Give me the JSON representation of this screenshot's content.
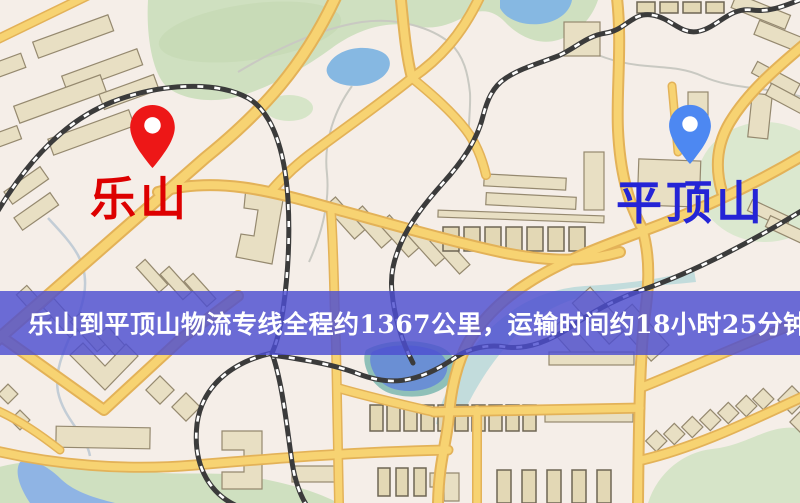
{
  "map": {
    "origin": {
      "name": "乐山",
      "pin_color": "#ed1717",
      "label_color": "#dd0000"
    },
    "destination": {
      "name": "平顶山",
      "pin_color": "#4d88f2",
      "label_color": "#2424d6"
    },
    "banner": {
      "text": "乐山到平顶山物流专线全程约1367公里，运输时间约18小时25分钟.",
      "background": "#4d4ed1",
      "text_color": "#ffffff",
      "distance_km": "1367",
      "duration_hours": "18",
      "duration_minutes": "25"
    },
    "palette": {
      "background": "#f5eee8",
      "road": "#f7d372",
      "road_casing": "#e3b258",
      "green_area": "#cfe0c0",
      "water": "#86b8e2",
      "river": "#9fcdd3",
      "building": "#e8dfc3",
      "railway": "#3b3b3b"
    }
  }
}
